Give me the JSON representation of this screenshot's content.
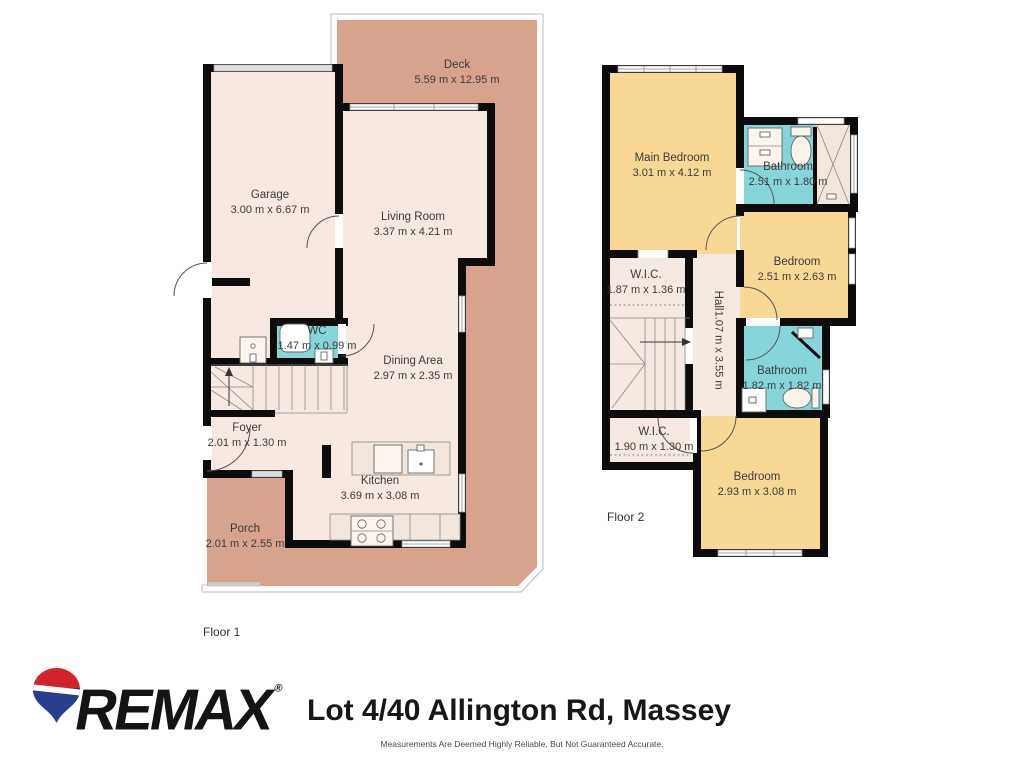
{
  "floor1": {
    "label": "Floor 1",
    "rooms": {
      "deck": {
        "name": "Deck",
        "dims": "5.59 m x 12.95 m"
      },
      "garage": {
        "name": "Garage",
        "dims": "3.00 m x 6.67 m"
      },
      "living": {
        "name": "Living Room",
        "dims": "3.37 m x 4.21 m"
      },
      "wc": {
        "name": "WC",
        "dims": "1.47 m x 0.99 m"
      },
      "dining": {
        "name": "Dining Area",
        "dims": "2.97 m x 2.35 m"
      },
      "foyer": {
        "name": "Foyer",
        "dims": "2.01 m x 1.30 m"
      },
      "kitchen": {
        "name": "Kitchen",
        "dims": "3.69 m x 3.08 m"
      },
      "porch": {
        "name": "Porch",
        "dims": "2.01 m x 2.55 m"
      }
    }
  },
  "floor2": {
    "label": "Floor 2",
    "rooms": {
      "main_bedroom": {
        "name": "Main Bedroom",
        "dims": "3.01 m x 4.12 m"
      },
      "bathroom_top": {
        "name": "Bathroom",
        "dims": "2.51 m x 1.80 m"
      },
      "bedroom_right": {
        "name": "Bedroom",
        "dims": "2.51 m x 2.63 m"
      },
      "wic_mid": {
        "name": "W.I.C.",
        "dims": "1.87 m x 1.36 m"
      },
      "hall": {
        "name": "Hall",
        "dims": "1.07 m x 3.55 m"
      },
      "bathroom_lower": {
        "name": "Bathroom",
        "dims": "1.82 m x 1.82 m"
      },
      "wic_lower": {
        "name": "W.I.C.",
        "dims": "1.90 m x 1.30 m"
      },
      "bedroom_lower": {
        "name": "Bedroom",
        "dims": "2.93 m x 3.08 m"
      }
    }
  },
  "footer": {
    "brand": "REMAX",
    "registered": "®",
    "title": "Lot 4/40 Allington Rd, Massey",
    "disclaimer": "Measurements Are Deemed Highly Reliable, But Not Guaranteed Accurate."
  },
  "colors": {
    "deck": "#d7a38c",
    "floor": "#f7e9e2",
    "bedroom": "#f9d794",
    "bathroom": "#86d6d9",
    "wall": "#0c0c0c",
    "balloon_red": "#d2232a",
    "balloon_blue": "#27408b"
  }
}
